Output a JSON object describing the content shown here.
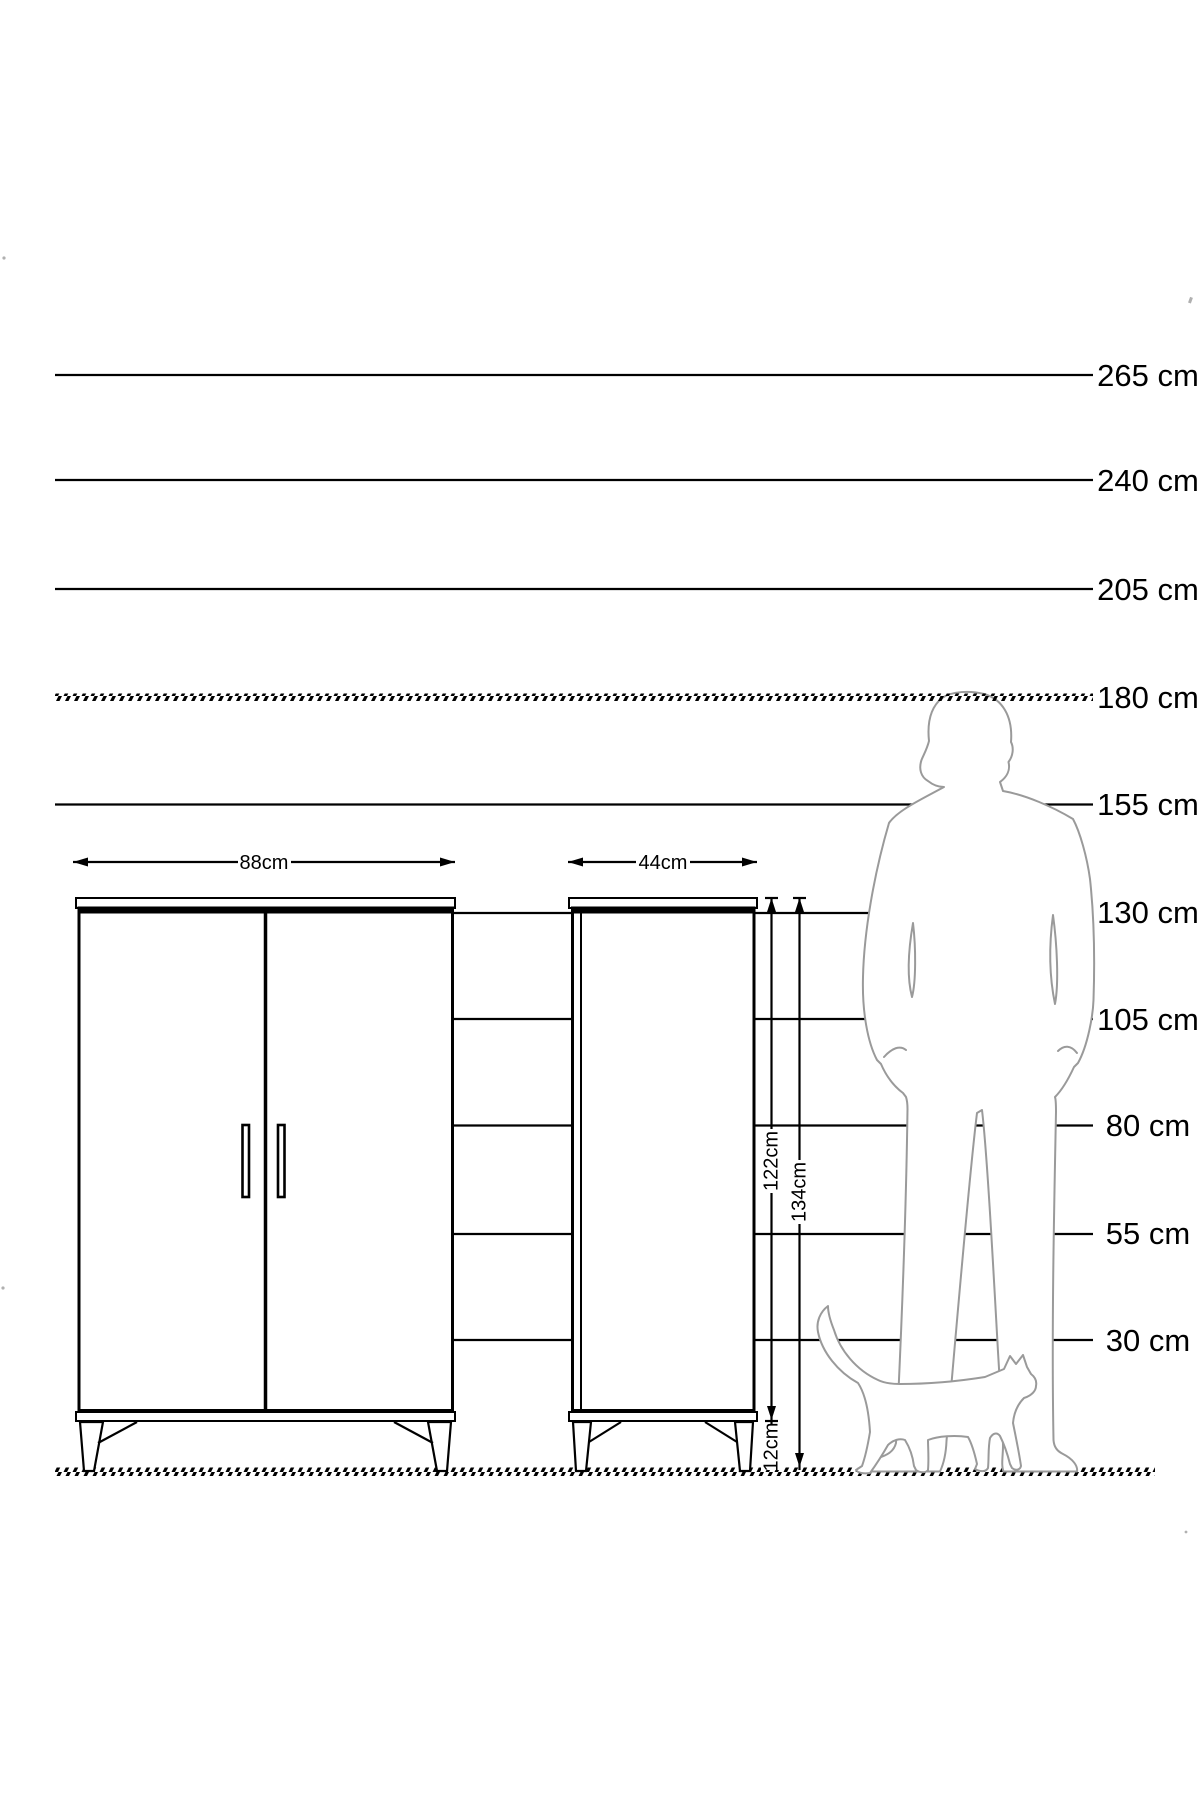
{
  "page": {
    "type": "furniture-dimension-diagram",
    "background": "#ffffff"
  },
  "scale": {
    "unit": "cm",
    "labels": [
      "265 cm",
      "240 cm",
      "205 cm",
      "180 cm",
      "155 cm",
      "130 cm",
      "105 cm",
      "80 cm",
      "55 cm",
      "30 cm"
    ],
    "values_cm": [
      265,
      240,
      205,
      180,
      155,
      130,
      105,
      80,
      55,
      30
    ]
  },
  "dimensions": {
    "wardrobe_width": "88cm",
    "cabinet_width": "44cm",
    "body_height": "122cm",
    "total_height": "134cm",
    "leg_height": "12cm"
  },
  "figures": [
    "man-silhouette",
    "cat-silhouette"
  ],
  "colors": {
    "ink": "#000000",
    "silhouette": "#9a9a9a",
    "background": "#ffffff"
  }
}
